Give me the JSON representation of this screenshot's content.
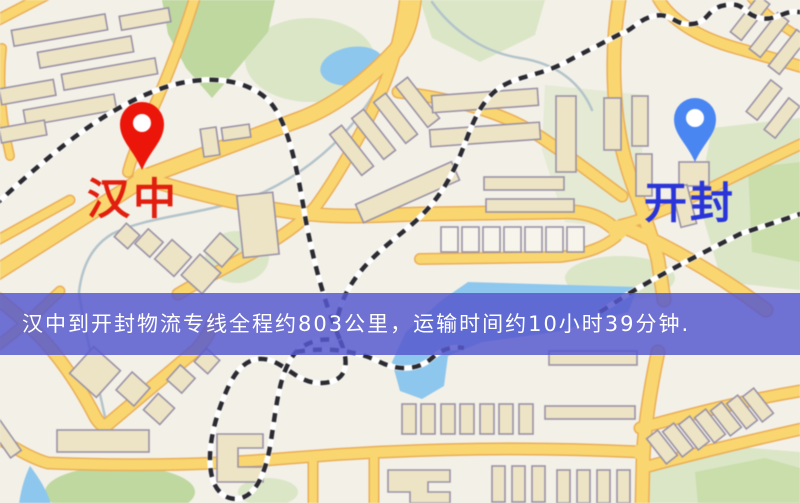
{
  "map": {
    "origin": {
      "label": "汉中"
    },
    "destination": {
      "label": "开封"
    }
  },
  "banner": {
    "text": "汉中到开封物流专线全程约803公里，运输时间约10小时39分钟."
  },
  "colors": {
    "map_background": "#f3f0e8",
    "road_fill": "#f8d672",
    "road_casing": "#e9ae5b",
    "building_fill": "#ede3c6",
    "building_fill_light": "#f7f4ec",
    "building_stroke": "#9a93a6",
    "park_green": "#bed8a1",
    "park_pale": "#dbe6c8",
    "park_mid": "#cadeac",
    "water_blue": "#8fc7ec",
    "stream": "#b3c4ca",
    "railway_dark": "#2a2a30",
    "railway_light": "#ffffff",
    "banner_bg": "rgba(86,88,206,0.84)",
    "banner_text": "#ffffff",
    "origin_pin": "#e7160b",
    "origin_label": "#dd1f10",
    "destination_pin": "#4c86ef",
    "destination_label": "#2b35d4"
  }
}
